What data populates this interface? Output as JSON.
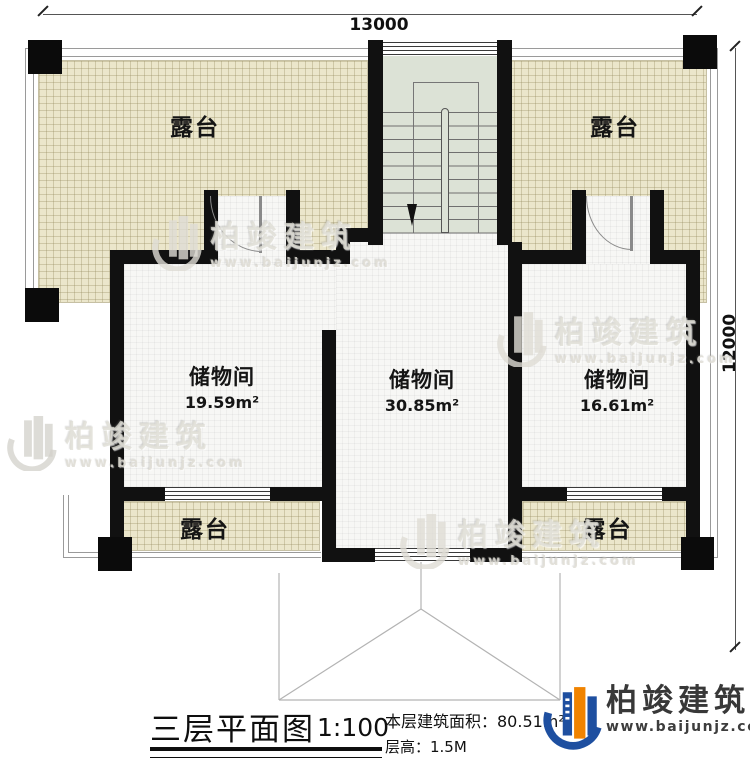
{
  "plan": {
    "dim_top": "13000",
    "dim_right": "12000"
  },
  "terraces": {
    "top_left": "露台",
    "top_right": "露台",
    "bottom_left": "露台",
    "bottom_right": "露台"
  },
  "rooms": [
    {
      "name": "储物间",
      "area": "19.59m²"
    },
    {
      "name": "储物间",
      "area": "30.85m²"
    },
    {
      "name": "储物间",
      "area": "16.61m²"
    }
  ],
  "title_block": {
    "title": "三层平面图",
    "scale": "1:100",
    "floor_area": "本层建筑面积：80.51m²",
    "floor_height": "层高：1.5M"
  },
  "logo": {
    "company": "柏竣建筑",
    "website": "www.baijunjz.com"
  },
  "watermark": {
    "company": "柏竣建筑",
    "website": "www.baijunjz.com"
  },
  "colors": {
    "wall": "#111111",
    "terrace_fill": "#ebe6cb",
    "stairwell_fill": "#dce2d6",
    "logo_blue": "#1e4fa0",
    "logo_orange": "#f08300"
  }
}
